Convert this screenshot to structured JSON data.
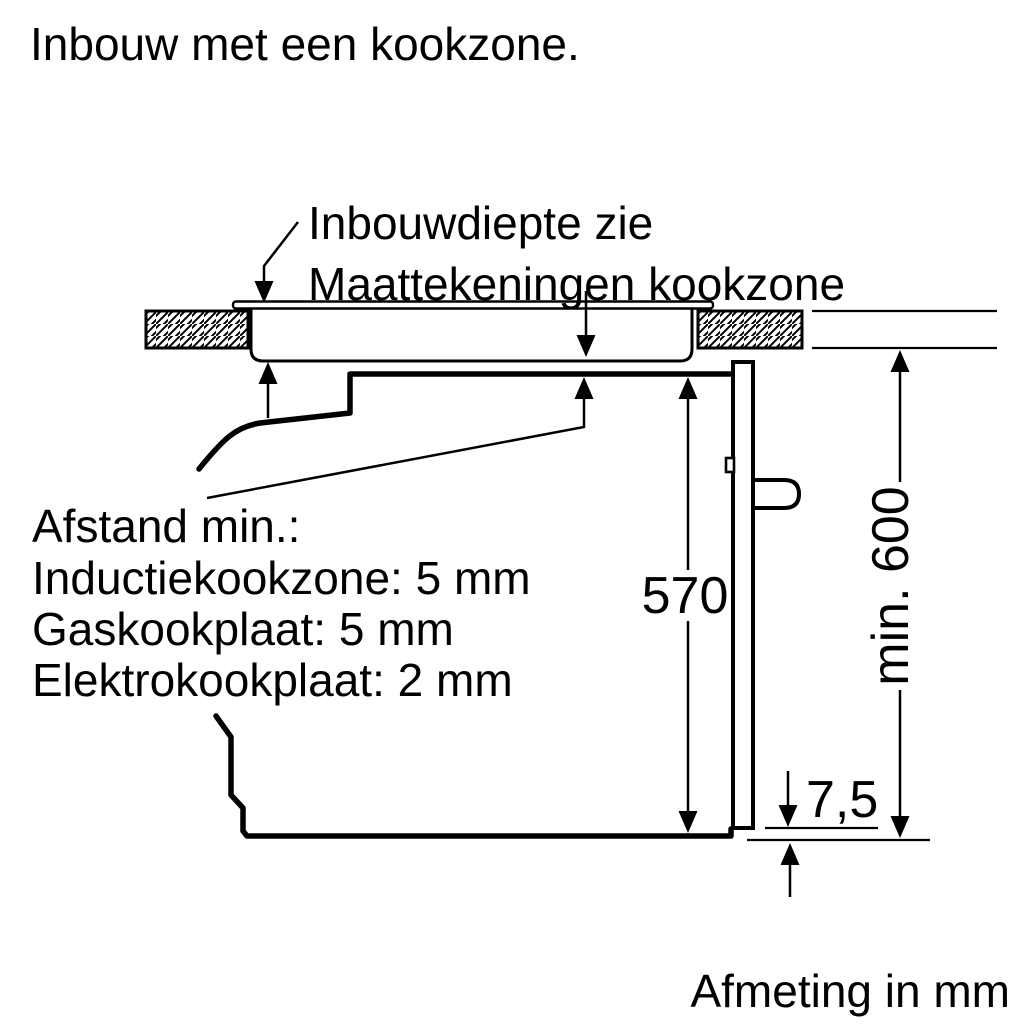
{
  "title": "Inbouw met een kookzone.",
  "top_callout": {
    "line1": "Inbouwdiepte zie",
    "line2": "Maattekeningen kookzone"
  },
  "clearance_callout": {
    "line1": "Afstand min.:",
    "line2": "Inductiekookzone: 5 mm",
    "line3": "Gaskookplaat: 5 mm",
    "line4": "Elektrokookplaat: 2 mm"
  },
  "dimensions": {
    "oven_height": "570",
    "niche_height": "min. 600",
    "bottom_gap": "7,5"
  },
  "footer_note": "Afmeting in mm",
  "colors": {
    "ink": "#000000",
    "background": "#ffffff"
  }
}
